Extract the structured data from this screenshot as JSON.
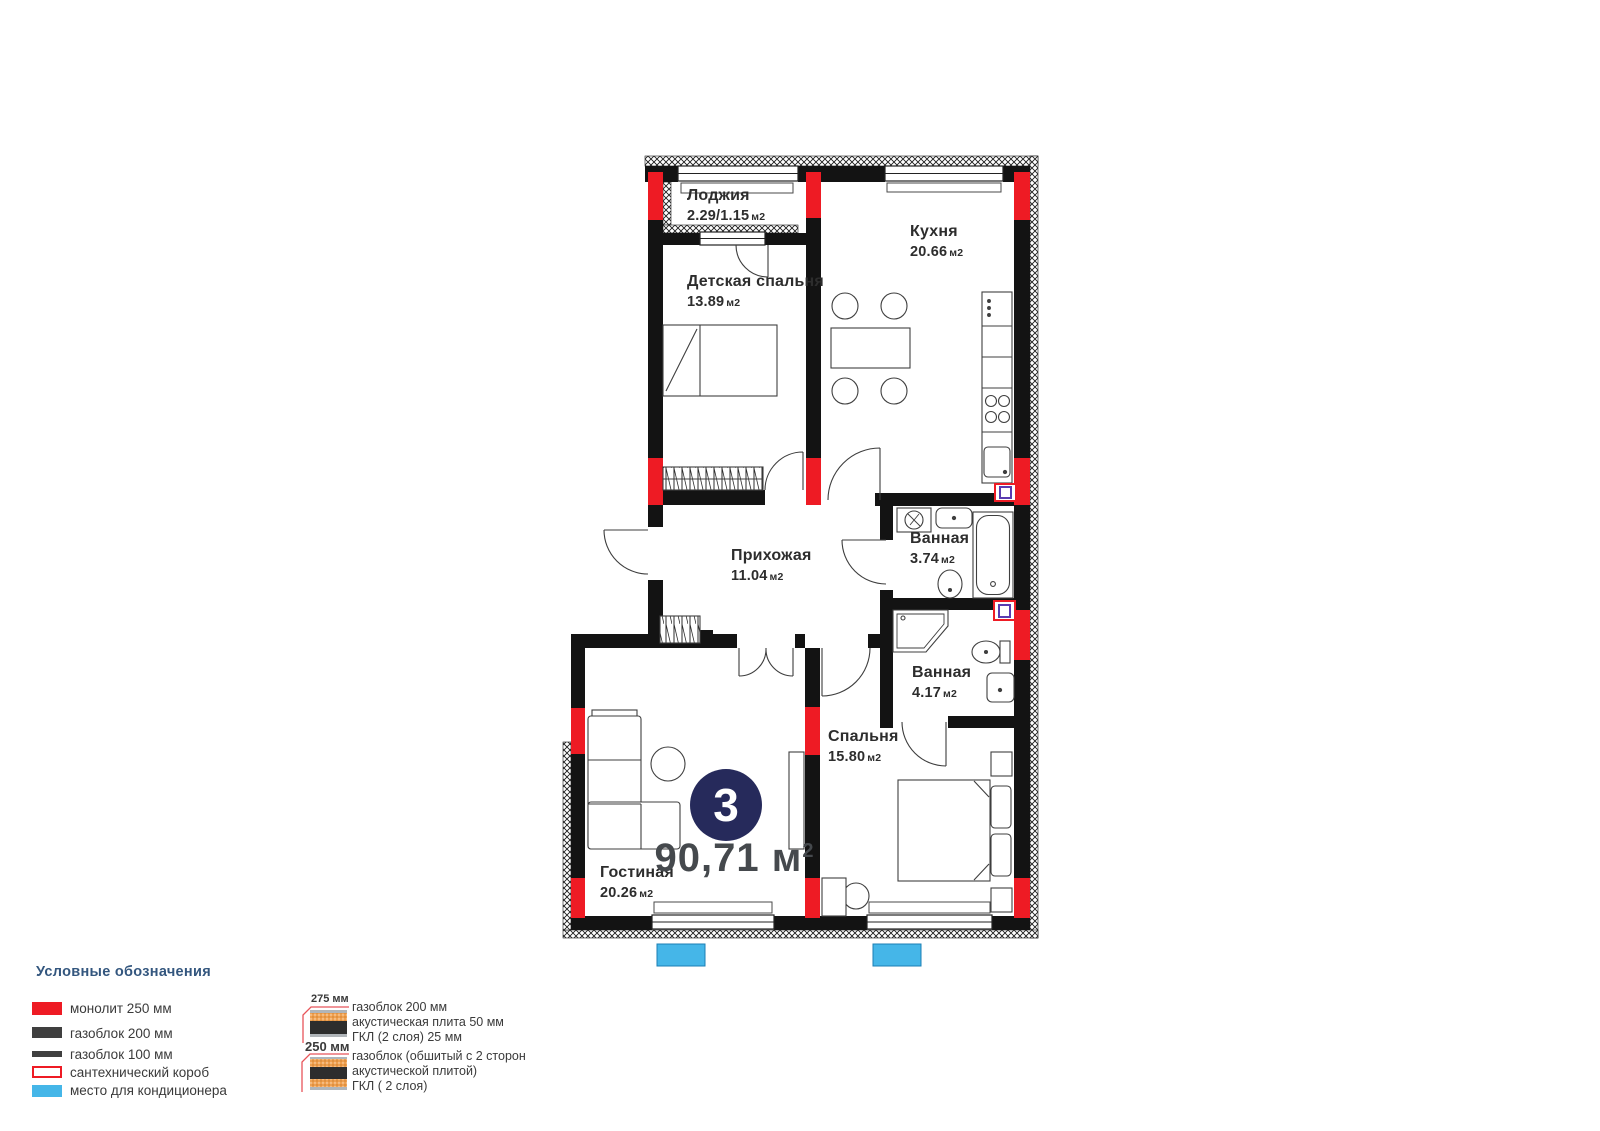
{
  "colors": {
    "monolith_red": "#ee1b24",
    "gas_block_dark": "#3f3f3f",
    "ac_blue": "#45b6e8",
    "badge_navy": "#262a5b",
    "legend_heading_blue": "#33567e"
  },
  "plan": {
    "badge_number": "3",
    "total_area_value": "90,71",
    "total_area_unit": "м",
    "total_area_superscript": "2",
    "rooms": [
      {
        "id": "loggia",
        "name": "Лоджия",
        "area": "2.29/1.15",
        "unit": "м2"
      },
      {
        "id": "kids_bedroom",
        "name": "Детская спальня",
        "area": "13.89",
        "unit": "м2"
      },
      {
        "id": "kitchen",
        "name": "Кухня",
        "area": "20.66",
        "unit": "м2"
      },
      {
        "id": "hallway",
        "name": "Прихожая",
        "area": "11.04",
        "unit": "м2"
      },
      {
        "id": "bathroom_1",
        "name": "Ванная",
        "area": "3.74",
        "unit": "м2"
      },
      {
        "id": "bathroom_2",
        "name": "Ванная",
        "area": "4.17",
        "unit": "м2"
      },
      {
        "id": "bedroom",
        "name": "Спальня",
        "area": "15.80",
        "unit": "м2"
      },
      {
        "id": "living_room",
        "name": "Гостиная",
        "area": "20.26",
        "unit": "м2"
      }
    ]
  },
  "legend": {
    "title": "Условные обозначения",
    "items": [
      {
        "label": "монолит 250 мм"
      },
      {
        "label": "газоблок 200 мм"
      },
      {
        "label": "газоблок 100 мм"
      },
      {
        "label": "сантехнический короб"
      },
      {
        "label": "место для кондиционера"
      }
    ],
    "wall_types": [
      {
        "dimension": "275 мм",
        "lines": [
          "газоблок 200 мм",
          "акустическая плита 50 мм",
          "ГКЛ (2 слоя) 25 мм"
        ]
      },
      {
        "dimension": "250 мм",
        "lines": [
          "газоблок (обшитый с 2 сторон",
          "акустической плитой)",
          "ГКЛ ( 2 слоя)"
        ]
      }
    ]
  }
}
